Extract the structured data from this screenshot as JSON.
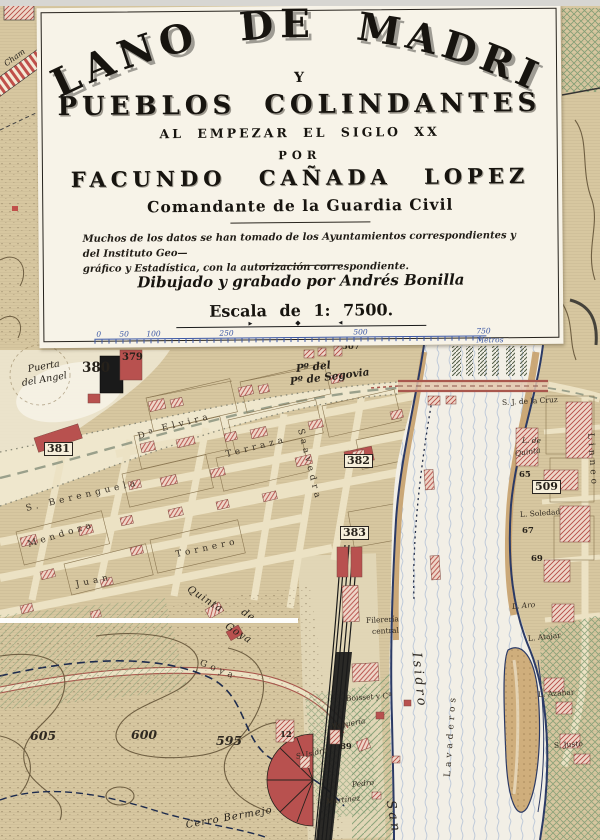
{
  "cartouche": {
    "title_arc": "PLANO DE MADRID",
    "conjunction": "Y",
    "subtitle": "PUEBLOS COLINDANTES",
    "period_line": "AL EMPEZAR EL SIGLO XX",
    "por": "POR",
    "author": "FACUNDO CAÑADA LOPEZ",
    "author_title": "Comandante de la Guardia Civil",
    "note_line1": "Muchos de los datos se han tomado de los Ayuntamientos correspondientes y del Instituto Geo—",
    "note_line2": "gráfico y Estadística, con la autorización correspondiente.",
    "credit": "Dibujado y grabado por Andrés Bonilla",
    "scale_label": "Escala de 1: 7500.",
    "ornament": {
      "left": "►",
      "center": "◆",
      "right": "◄"
    },
    "scale_bar": {
      "units": "Metros",
      "ticks": [
        {
          "text": "0",
          "x": 7
        },
        {
          "text": "50",
          "x": 30
        },
        {
          "text": "100",
          "x": 57
        },
        {
          "text": "250",
          "x": 130
        },
        {
          "text": "500",
          "x": 264
        },
        {
          "text": "750 Metros",
          "x": 387
        }
      ]
    }
  },
  "map": {
    "labels": [
      {
        "text": "Cham",
        "x": 5,
        "y": 60,
        "rot": -36,
        "cls": "place-sm"
      },
      {
        "text": "Puerta",
        "x": 28,
        "y": 364,
        "rot": -10,
        "cls": "place"
      },
      {
        "text": "del Angel",
        "x": 22,
        "y": 378,
        "rot": -10,
        "cls": "place"
      },
      {
        "text": "380",
        "x": 82,
        "y": 360,
        "cls": "num-big"
      },
      {
        "text": "379",
        "x": 122,
        "y": 352,
        "cls": "num"
      },
      {
        "text": "381",
        "x": 44,
        "y": 442,
        "cls": "num-box"
      },
      {
        "text": "507",
        "x": 342,
        "y": 342,
        "cls": "num-sm"
      },
      {
        "text": "Pº del",
        "x": 296,
        "y": 363,
        "rot": -6,
        "cls": "road-it"
      },
      {
        "text": "Pº de Segovia",
        "x": 290,
        "y": 376,
        "rot": -7,
        "cls": "road-it"
      },
      {
        "text": "S. J. de la Cruz",
        "x": 502,
        "y": 398,
        "rot": -3,
        "cls": "tiny"
      },
      {
        "text": "L. de",
        "x": 522,
        "y": 436,
        "cls": "tiny-it"
      },
      {
        "text": "Quinta",
        "x": 515,
        "y": 449,
        "rot": -8,
        "cls": "tiny-it"
      },
      {
        "text": "Linneo",
        "x": 590,
        "y": 428,
        "rot": 86,
        "cls": "street-sp"
      },
      {
        "text": "65",
        "x": 519,
        "y": 470,
        "cls": "num-sm"
      },
      {
        "text": "509",
        "x": 532,
        "y": 480,
        "cls": "num-box"
      },
      {
        "text": "L. Soledad",
        "x": 520,
        "y": 510,
        "rot": -4,
        "cls": "tiny"
      },
      {
        "text": "67",
        "x": 522,
        "y": 526,
        "cls": "num-sm"
      },
      {
        "text": "69",
        "x": 531,
        "y": 554,
        "cls": "num-sm"
      },
      {
        "text": "L. Aro",
        "x": 512,
        "y": 602,
        "rot": -5,
        "cls": "tiny-it"
      },
      {
        "text": "L. Atajar",
        "x": 528,
        "y": 634,
        "rot": -6,
        "cls": "tiny"
      },
      {
        "text": "L. Azahar",
        "x": 538,
        "y": 690,
        "rot": -4,
        "cls": "tiny"
      },
      {
        "text": "S. Justo",
        "x": 554,
        "y": 741,
        "rot": -4,
        "cls": "tiny"
      },
      {
        "text": "382",
        "x": 344,
        "y": 454,
        "cls": "num-box"
      },
      {
        "text": "383",
        "x": 340,
        "y": 526,
        "cls": "num-box"
      },
      {
        "text": "Dª",
        "x": 138,
        "y": 432,
        "rot": -14,
        "cls": "street-sp"
      },
      {
        "text": "Elvira",
        "x": 162,
        "y": 424,
        "rot": -14,
        "cls": "street-sp"
      },
      {
        "text": "Terraza",
        "x": 226,
        "y": 450,
        "rot": -14,
        "cls": "street-sp"
      },
      {
        "text": "Saavedra",
        "x": 300,
        "y": 424,
        "rot": 76,
        "cls": "street-sp"
      },
      {
        "text": "S. Berenguela",
        "x": 26,
        "y": 504,
        "rot": -13,
        "cls": "street-sp"
      },
      {
        "text": "Mendoza",
        "x": 28,
        "y": 540,
        "rot": -17,
        "cls": "street-sp"
      },
      {
        "text": "Juan",
        "x": 76,
        "y": 580,
        "rot": -12,
        "cls": "street-sp"
      },
      {
        "text": "Tornero",
        "x": 176,
        "y": 550,
        "rot": -12,
        "cls": "street-sp"
      },
      {
        "text": "Quinta",
        "x": 188,
        "y": 583,
        "rot": 33,
        "cls": "street-it"
      },
      {
        "text": "de",
        "x": 242,
        "y": 606,
        "rot": 33,
        "cls": "street-it"
      },
      {
        "text": "Goya",
        "x": 226,
        "y": 620,
        "rot": 33,
        "cls": "street-it"
      },
      {
        "text": "Goya",
        "x": 200,
        "y": 658,
        "rot": 22,
        "cls": "street-sp"
      },
      {
        "text": "605",
        "x": 30,
        "y": 728,
        "cls": "contour"
      },
      {
        "text": "600",
        "x": 131,
        "y": 727,
        "cls": "contour"
      },
      {
        "text": "595",
        "x": 216,
        "y": 733,
        "cls": "contour"
      },
      {
        "text": "Cerro Bermejo",
        "x": 186,
        "y": 820,
        "rot": -10,
        "cls": "street-it"
      },
      {
        "text": "Boisset y Cª",
        "x": 346,
        "y": 694,
        "rot": -4,
        "cls": "tiny"
      },
      {
        "text": "Vaquería",
        "x": 332,
        "y": 722,
        "rot": -10,
        "cls": "tiny-it"
      },
      {
        "text": "89",
        "x": 340,
        "y": 742,
        "cls": "num-sm"
      },
      {
        "text": "12",
        "x": 280,
        "y": 730,
        "cls": "num-sm"
      },
      {
        "text": "S. Isidro",
        "x": 296,
        "y": 752,
        "rot": -12,
        "cls": "tiny-it"
      },
      {
        "text": "Pedro",
        "x": 352,
        "y": 780,
        "rot": -6,
        "cls": "tiny-it"
      },
      {
        "text": "Martínez",
        "x": 326,
        "y": 797,
        "rot": -6,
        "cls": "tiny-it"
      },
      {
        "text": "Filerería",
        "x": 366,
        "y": 616,
        "rot": -3,
        "cls": "tiny"
      },
      {
        "text": "central",
        "x": 372,
        "y": 627,
        "rot": -3,
        "cls": "tiny"
      },
      {
        "text": "Isidro",
        "x": 416,
        "y": 645,
        "rot": 84,
        "cls": "road-big"
      },
      {
        "text": "San",
        "x": 390,
        "y": 793,
        "rot": 80,
        "cls": "road-big"
      },
      {
        "text": "Lavaderos",
        "x": 448,
        "y": 772,
        "rot": -86,
        "cls": "street-sp"
      }
    ]
  },
  "colors": {
    "paper": "#f7f3e8",
    "map_tan": "#d7c7a0",
    "ink": "#17140f",
    "scale_blue": "#3b57a5",
    "building_red": "#b8514f",
    "hatch_red": "#c2544e",
    "water_blue": "#b9c6d8",
    "bank_blue": "#2b3a66",
    "green": "#7d9b72",
    "sand": "#c8a371",
    "rail_black": "#1a1a1a",
    "road_red": "#a9574d",
    "contour_brown": "#6f5f42",
    "boundary_navy": "#1d2b4e"
  }
}
